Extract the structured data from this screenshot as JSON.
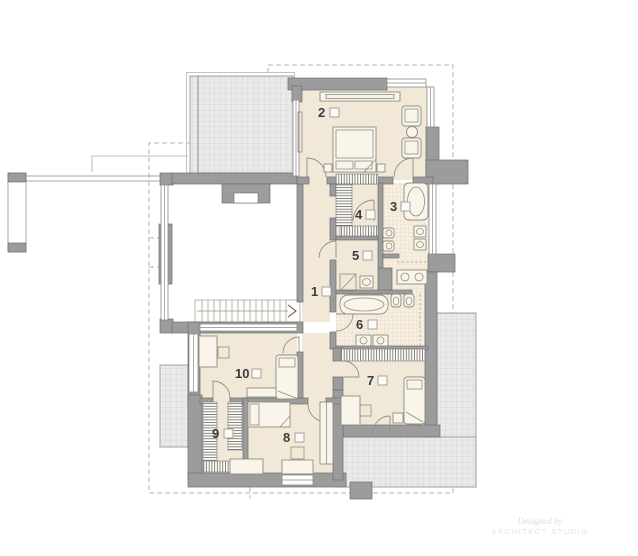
{
  "plan": {
    "type": "floor-plan-upper-storey",
    "rooms": [
      {
        "label": "1"
      },
      {
        "label": "2"
      },
      {
        "label": "3"
      },
      {
        "label": "4"
      },
      {
        "label": "5"
      },
      {
        "label": "6"
      },
      {
        "label": "7"
      },
      {
        "label": "8"
      },
      {
        "label": "9"
      },
      {
        "label": "10"
      }
    ],
    "watermark": {
      "line1": "Designed by",
      "line2": "ARCHITECT STUDIO"
    },
    "colors": {
      "wall": "#9c9c9c",
      "floor_cream": "#f2e8d8",
      "bathroom_tile": "#f7eee0",
      "roof_hatch_fill": "#eaeaea",
      "roof_hatch_line": "#c9c9c9",
      "dashed_outline": "#b3b3b3",
      "furniture_line": "#8d8d80",
      "label_text": "#3b3b3b"
    }
  }
}
